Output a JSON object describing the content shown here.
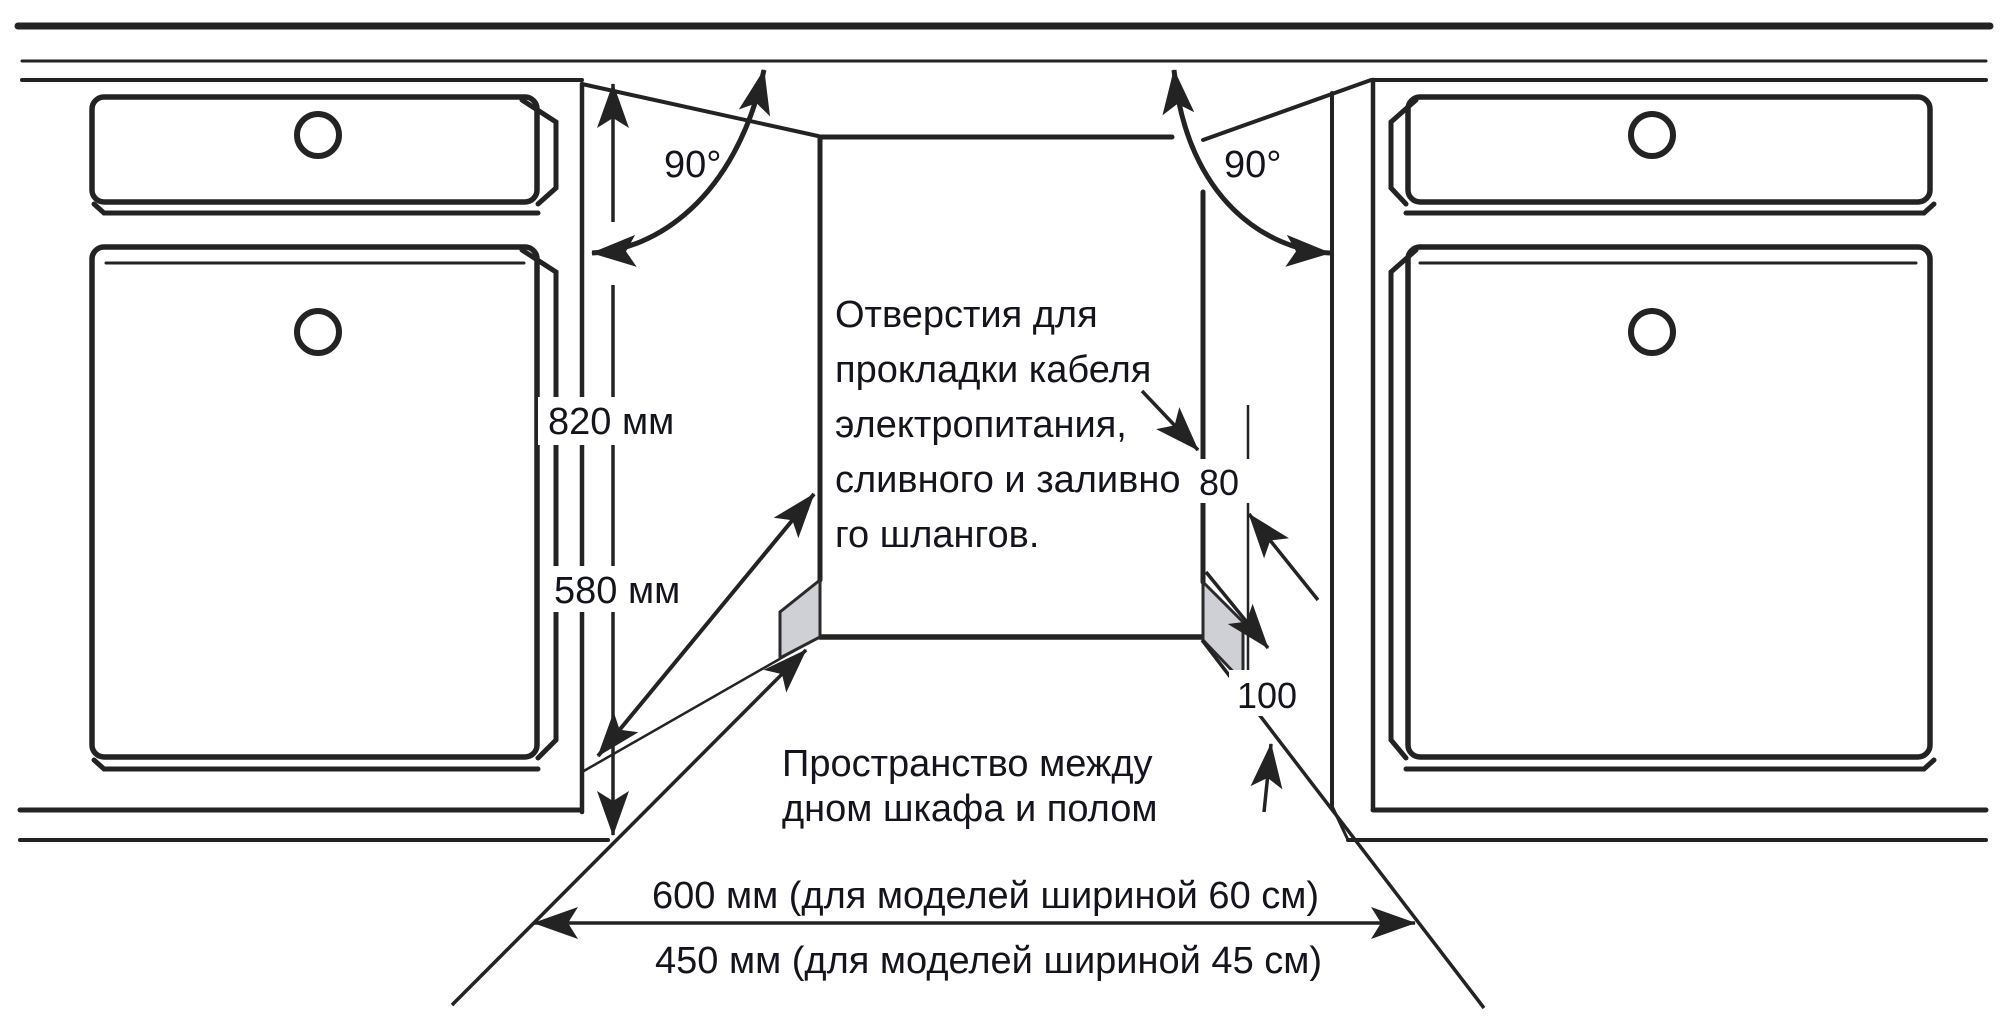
{
  "diagram": {
    "background": "#ffffff",
    "line_color": "#232323",
    "text_color": "#14141e",
    "hole_fill": "#cfd0d5",
    "labels": {
      "angle_left": "90°",
      "angle_right": "90°",
      "niche_height": "820 мм",
      "niche_depth": "580 мм",
      "hole_offset": "80",
      "floor_clearance": "100",
      "holes_note_lines": [
        "Отверстия для",
        "прокладки кабеля",
        "электропитания,",
        "сливного и заливно",
        "го шлангов."
      ],
      "floor_note_lines": [
        "Пространство между",
        "дном шкафа и полом"
      ],
      "width_note_60": "600 мм (для моделей шириной 60 см)",
      "width_note_45": "450 мм (для моделей шириной 45 см)"
    }
  }
}
